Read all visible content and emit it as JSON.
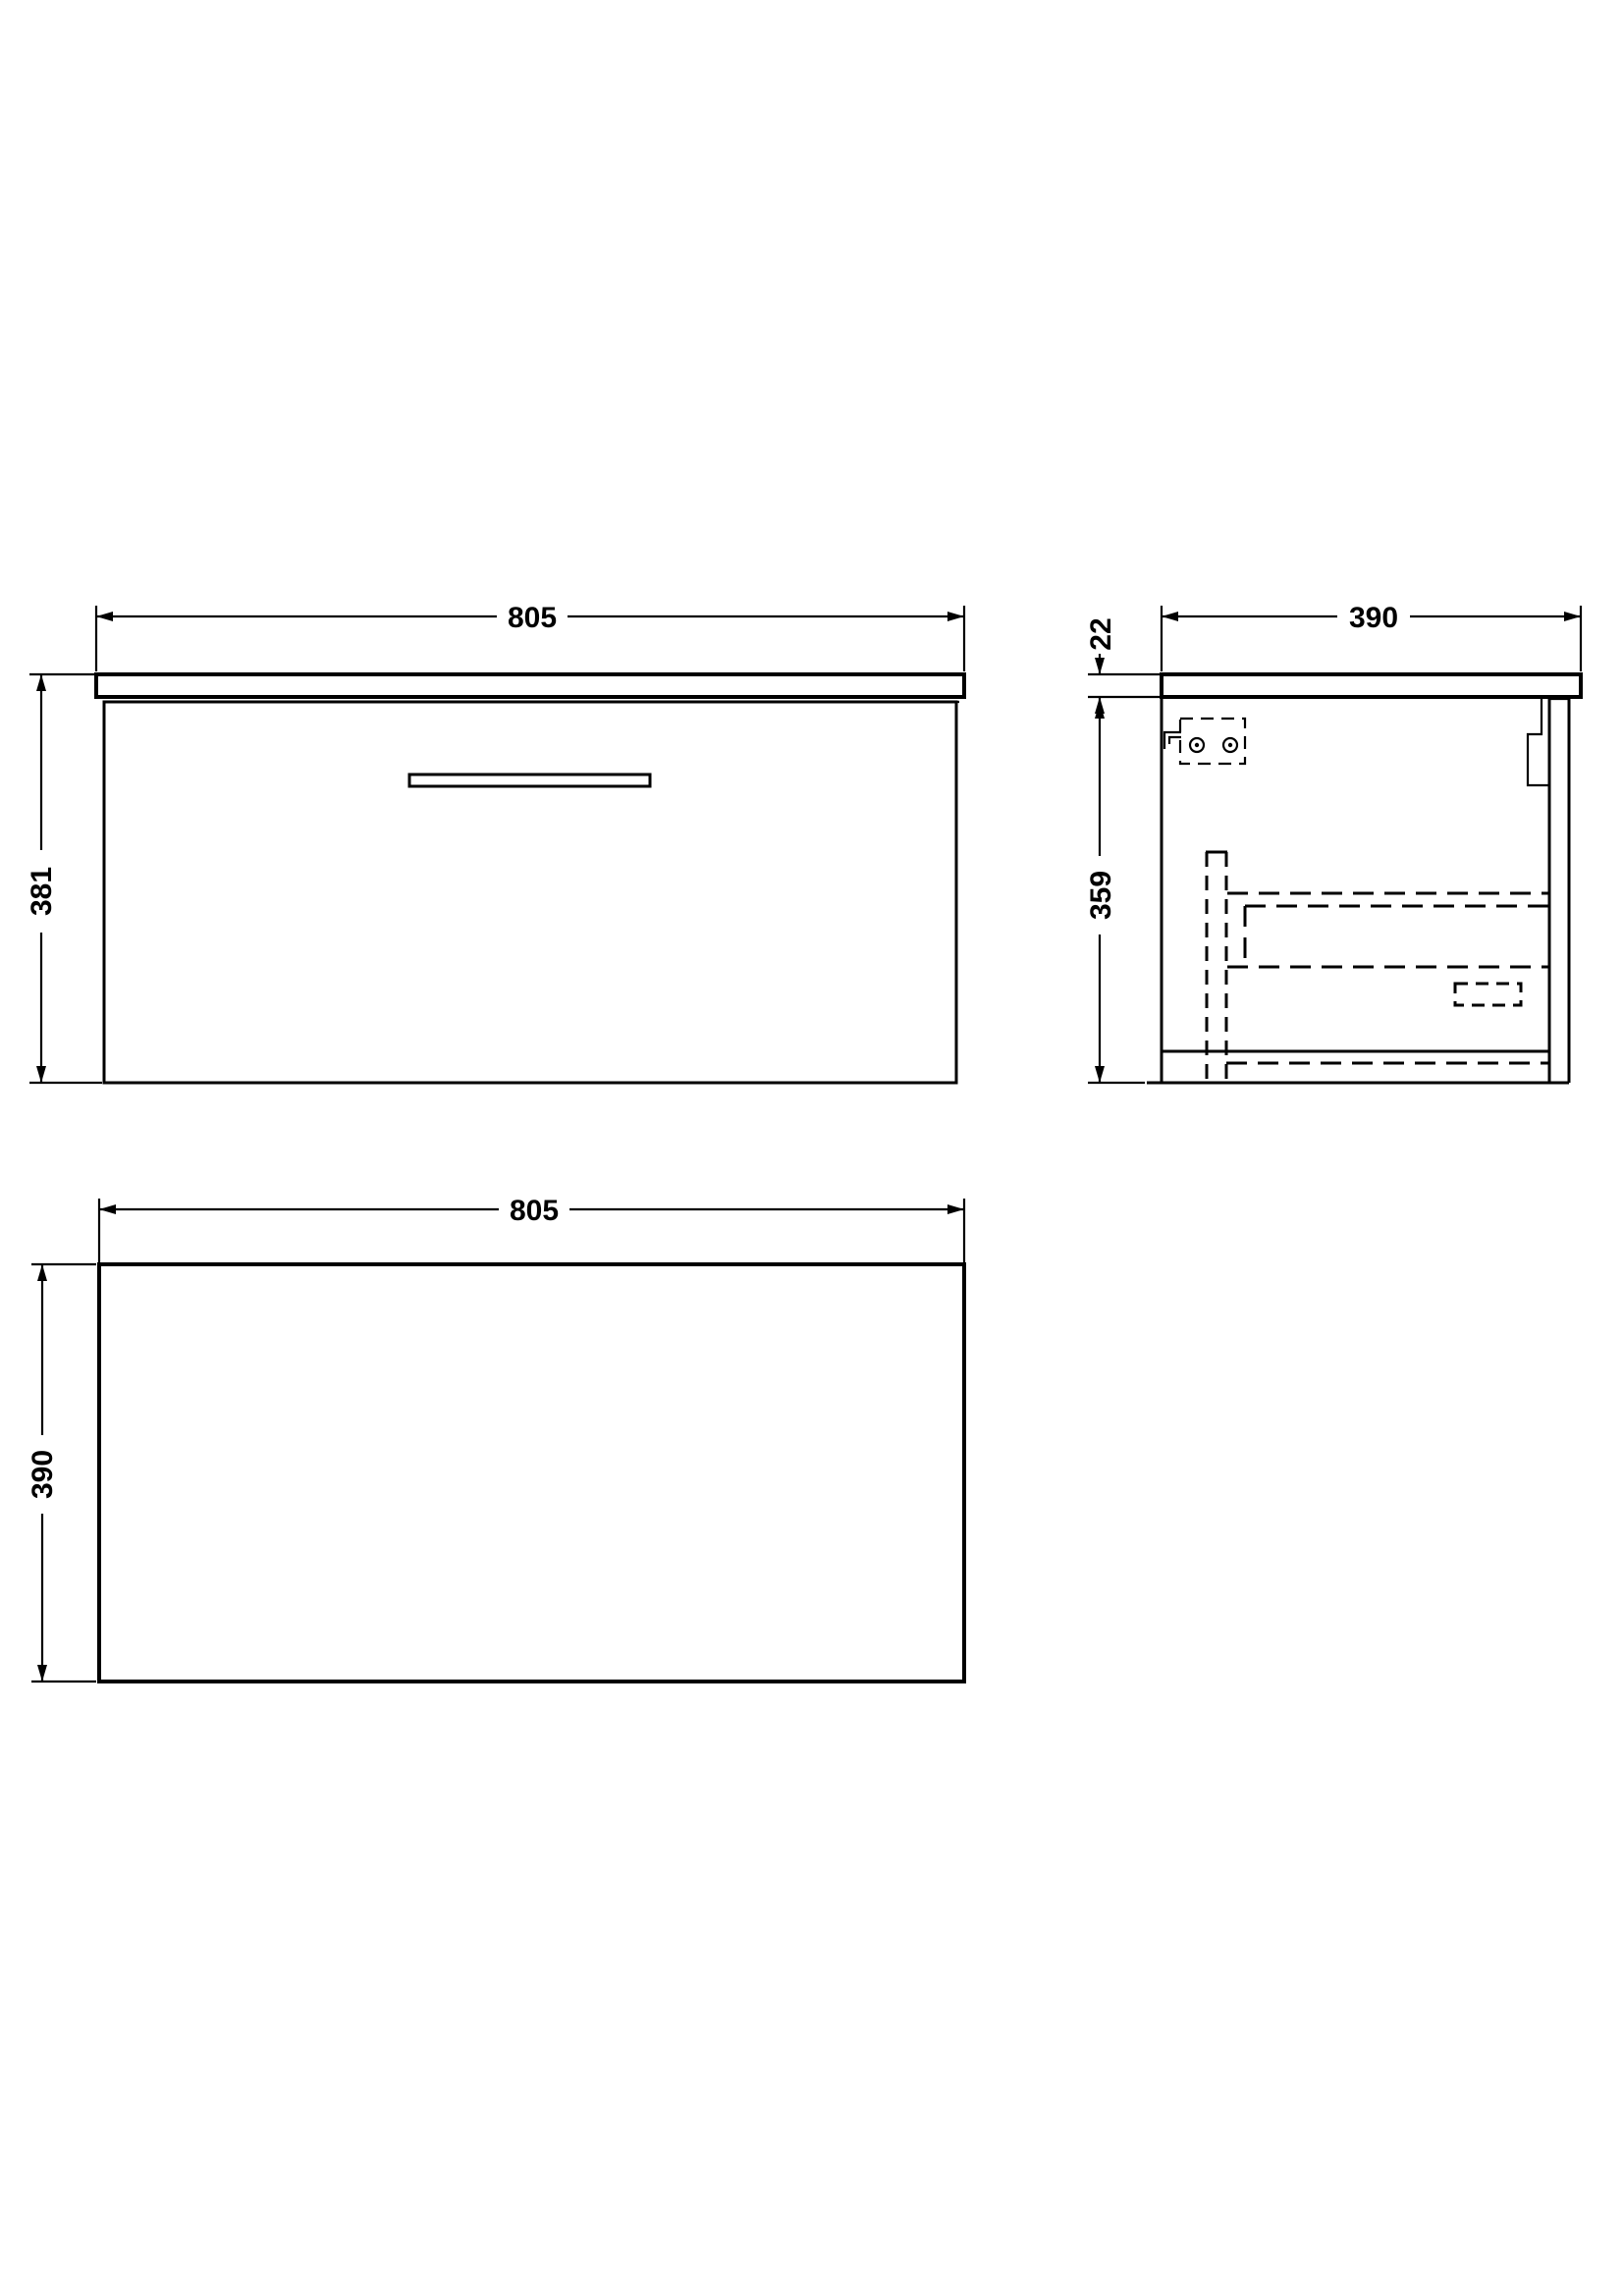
{
  "page": {
    "background_color": "#ffffff",
    "line_color": "#000000",
    "drawing_type": "wall-hung-drawer-unit-orthographic-views"
  },
  "views": {
    "front": {
      "label": "front-elevation",
      "width_dim": "805",
      "height_dim": "381"
    },
    "side": {
      "label": "side-section",
      "depth_dim": "390",
      "worktop_thickness_dim": "22",
      "carcass_height_dim": "359"
    },
    "plan": {
      "label": "plan-view",
      "width_dim": "805",
      "depth_dim": "390"
    }
  }
}
